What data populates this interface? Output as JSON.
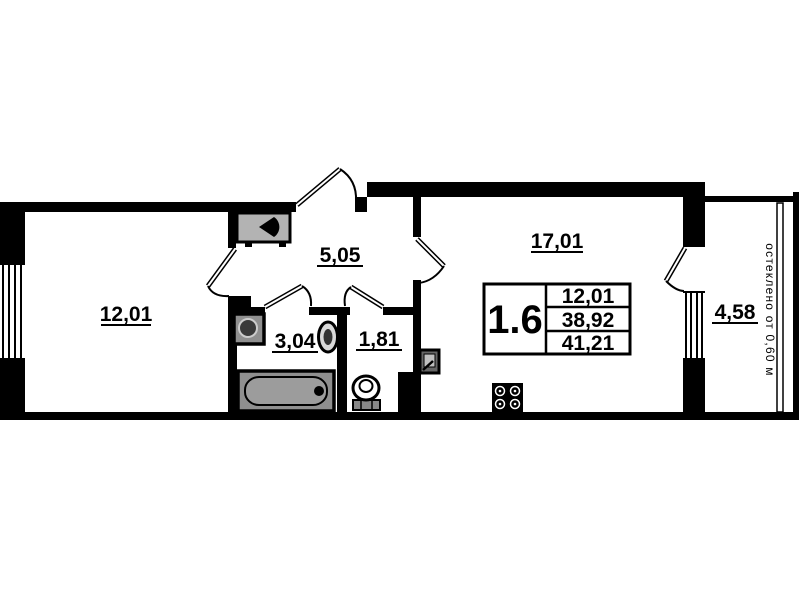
{
  "plan": {
    "unit_label": "1.6",
    "info_box": {
      "values": [
        "12,01",
        "38,92",
        "41,21"
      ]
    },
    "rooms": [
      {
        "id": "bedroom",
        "area_label": "12,01"
      },
      {
        "id": "hallway",
        "area_label": "5,05"
      },
      {
        "id": "bathroom",
        "area_label": "3,04"
      },
      {
        "id": "wc",
        "area_label": "1,81"
      },
      {
        "id": "kitchen-living",
        "area_label": "17,01"
      },
      {
        "id": "balcony",
        "area_label": "4,58"
      }
    ],
    "balcony_note": "остеклено от 0,60 м",
    "colors": {
      "wall": "#000000",
      "fixture_gray": "#8f8f8f",
      "vent_gray": "#b3b3b3",
      "background": "#ffffff"
    }
  }
}
